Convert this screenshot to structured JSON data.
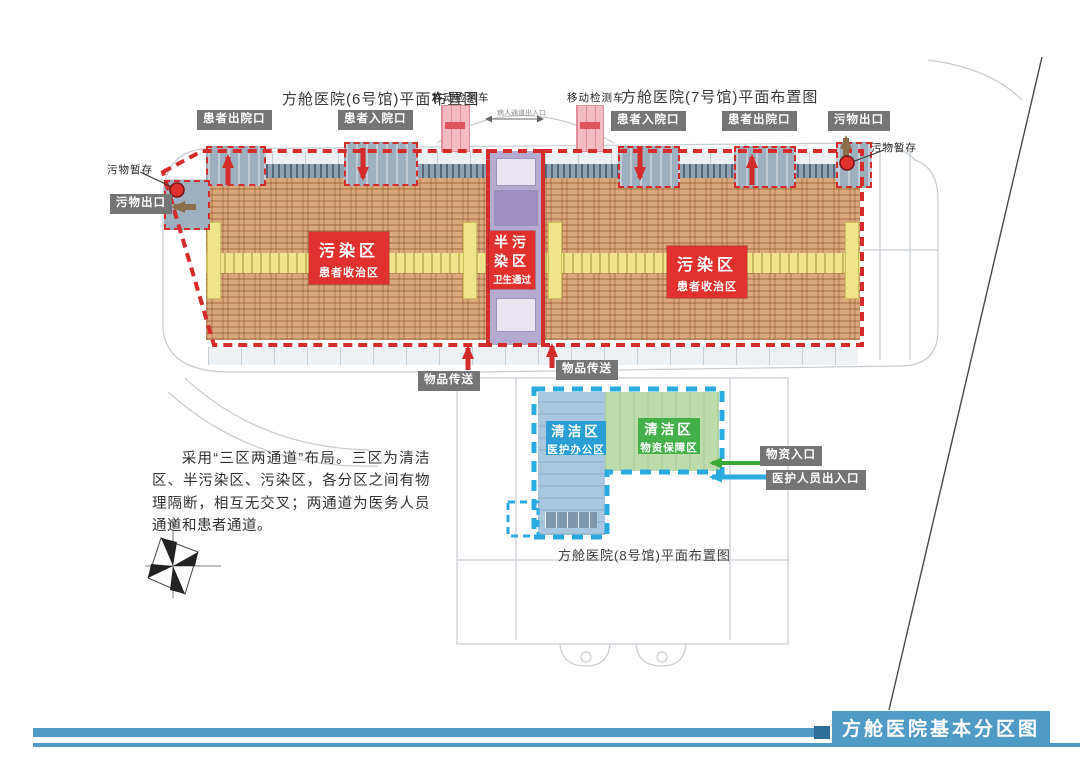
{
  "banner": {
    "title": "方舱医院基本分区图"
  },
  "titles": {
    "hall6": "方舱医院(6号馆)平面布置图",
    "hall7": "方舱医院(7号馆)平面布置图",
    "hall8": "方舱医院(8号馆)平面布置图"
  },
  "description": "采用“三区两通道”布局。三区为清洁区、半污染区、污染区，各分区之间有物理隔断，相互无交叉；两通道为医务人员通道和患者通道。",
  "tags": {
    "patient_exit_left": "患者出院口",
    "patient_entry_left": "患者入院口",
    "patient_entry_right": "患者入院口",
    "patient_exit_right": "患者出院口",
    "waste_exit_top_right": "污物出口",
    "waste_exit_left": "污物出口",
    "goods_transfer_left": "物品传送",
    "goods_transfer_right": "物品传送",
    "supplies_entry": "物资入口",
    "staff_entry": "医护人员出入口"
  },
  "notes": {
    "waste_storage_left": "污物暂存",
    "waste_storage_right": "污物暂存",
    "mobile_test_left": "移动检测车",
    "mobile_test_right": "移动检测车",
    "patient_passage": "病人通道出入口",
    "compass_north": "N"
  },
  "zones": {
    "contaminated_left": {
      "title": "污染区",
      "subtitle": "患者收治区"
    },
    "contaminated_right": {
      "title": "污染区",
      "subtitle": "患者收治区"
    },
    "semi_contaminated": {
      "title_line1": "半污",
      "title_line2": "染区",
      "subtitle": "卫生通过"
    },
    "clean_office": {
      "title": "清洁区",
      "subtitle": "医护办公区"
    },
    "clean_supply": {
      "title": "清洁区",
      "subtitle": "物资保障区"
    }
  },
  "colors": {
    "zone_red": "#e0312f",
    "clean_blue": "#2a9fd6",
    "clean_green": "#44b04a",
    "dashed_red": "#d42b2b",
    "dashed_blue": "#29abe2",
    "bed_area_tan": "#d9a87b",
    "corridor_yellow": "#efe38c",
    "semi_zone_purple": "#b5aacf",
    "banner_blue": "#4f9bc6",
    "tag_gray": "#757575"
  }
}
